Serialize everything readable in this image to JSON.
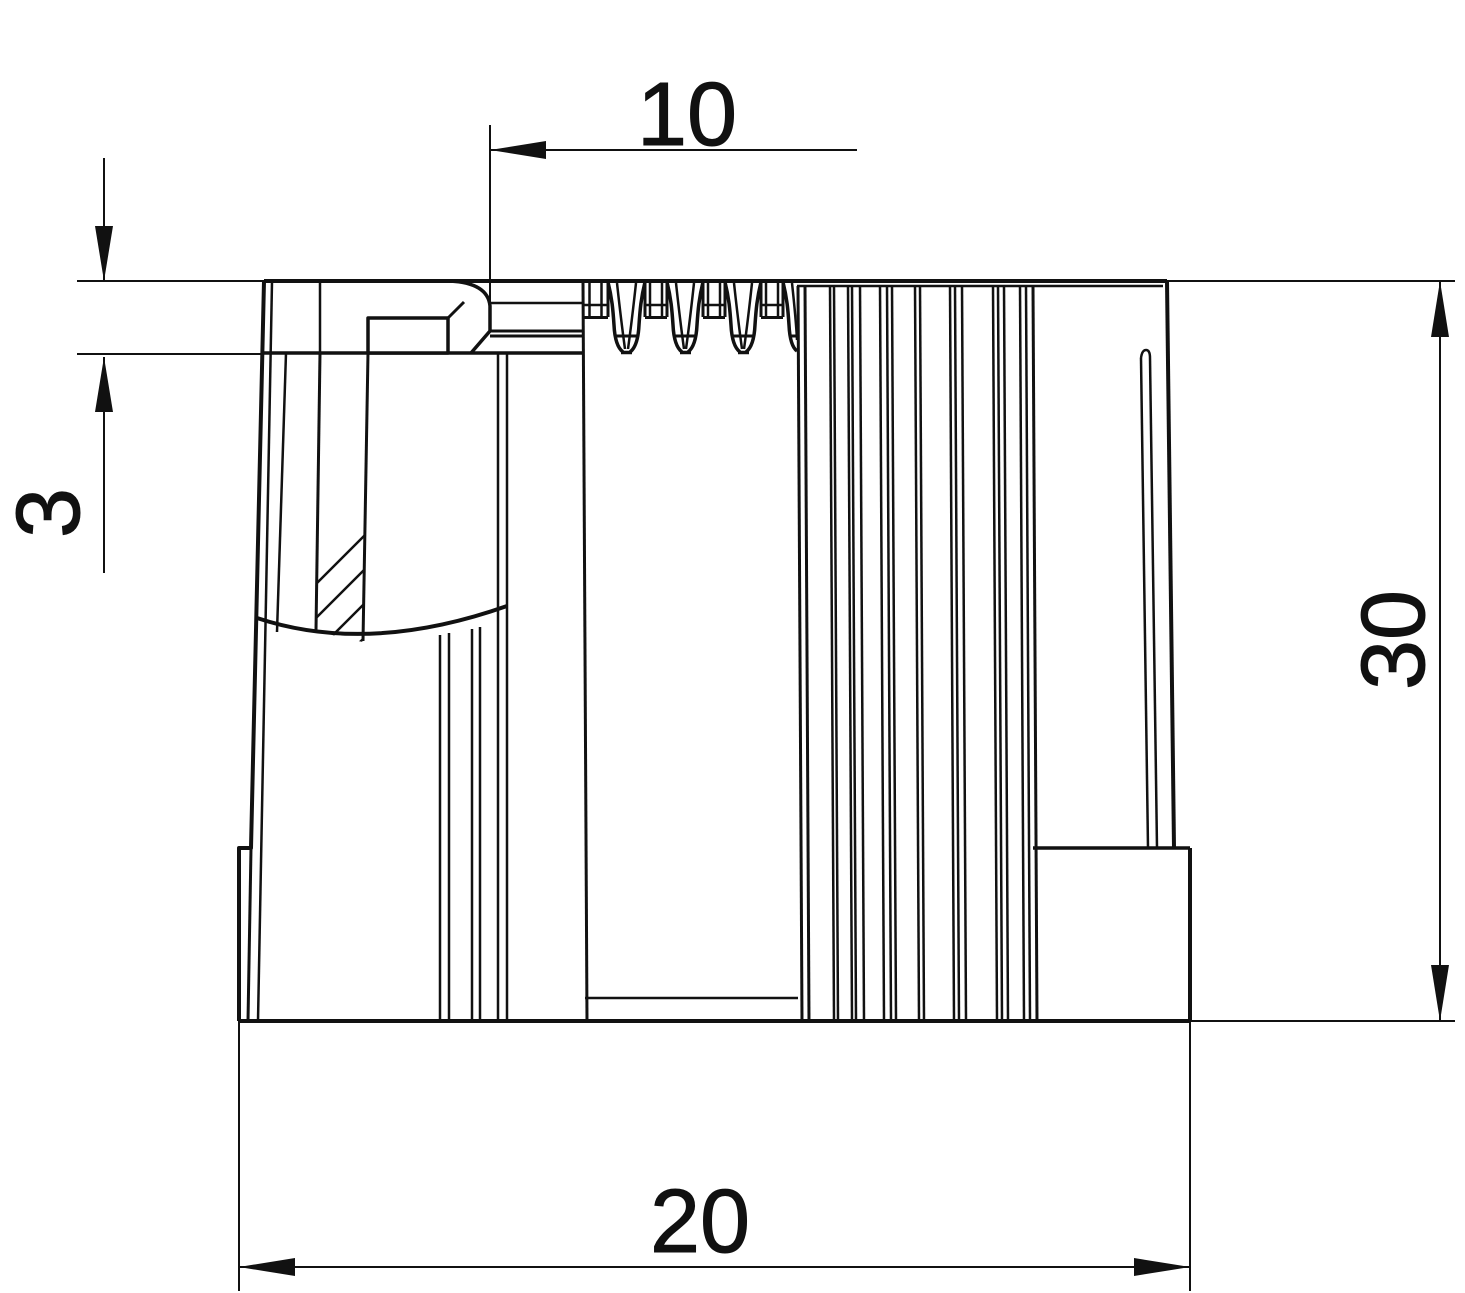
{
  "drawing": {
    "background": "#ffffff",
    "line_color": "#111111",
    "description": "2D section drawing of a ribbed tube end cap"
  },
  "dimensions": {
    "d10": "10",
    "d3": "3",
    "d30": "30",
    "d20": "20"
  }
}
